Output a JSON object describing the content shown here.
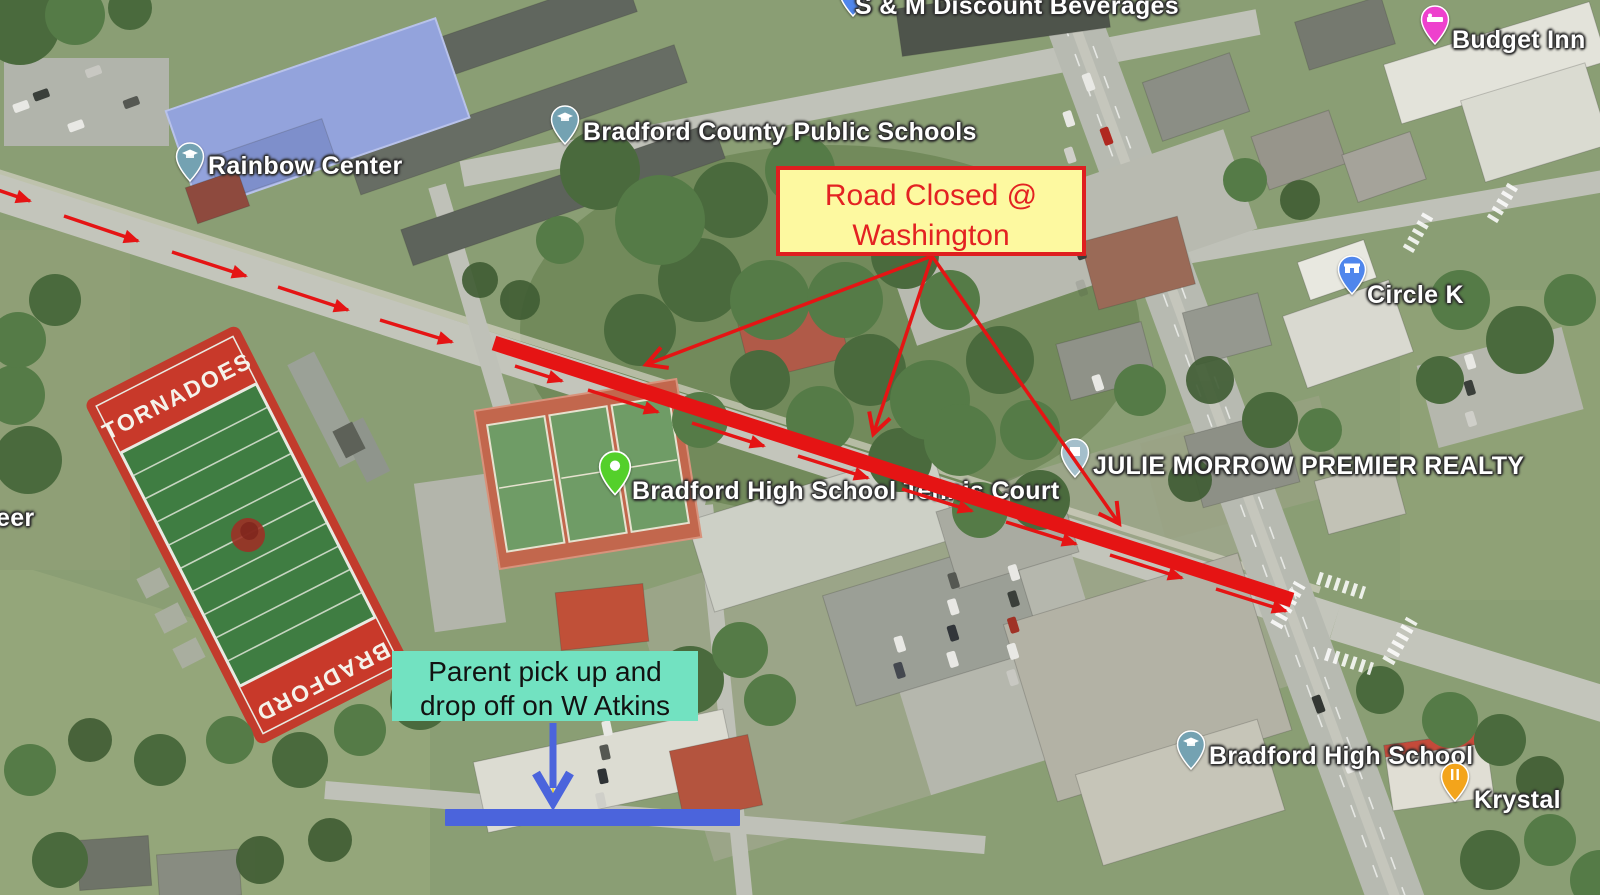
{
  "page": {
    "type": "annotated-satellite-map",
    "description": "Aerial map of Bradford High School area with road-closure and parent pick-up annotations"
  },
  "colors": {
    "annotation_red": "#e51414",
    "road_closed_bg": "#fdf9a0",
    "road_closed_border": "#df1f1f",
    "road_closed_text": "#e32222",
    "pickup_bg": "#72e2c1",
    "pickup_text": "#121212",
    "pickup_blue": "#4b64dc",
    "label_text": "#ffffff",
    "pin_school": "#74a2b2",
    "pin_tennis": "#54d02b",
    "pin_store": "#4f86ec",
    "pin_hotel": "#ee41cd",
    "pin_food": "#f3a41b",
    "pin_realty": "#a4bfcb",
    "endzone_red": "#c8392a",
    "field_green": "#3f7d42"
  },
  "map_labels": {
    "rainbow_center": "Rainbow Center",
    "bradford_county_public_schools": "Bradford County Public Schools",
    "sm_discount_beverages": "S & M Discount Beverages",
    "budget_inn": "Budget Inn",
    "circle_k": "Circle K",
    "julie_morrow_premier_realty": "JULIE MORROW PREMIER REALTY",
    "bradford_hs_tennis_court": "Bradford High School Tennis Court",
    "bradford_high_school": "Bradford High School",
    "krystal": "Krystal",
    "left_edge_partial": "reer"
  },
  "football_field": {
    "top_endzone": "TORNADOES",
    "bottom_endzone": "BRADFORD"
  },
  "annotations": {
    "road_closed": {
      "line1": "Road Closed @",
      "line2": "Washington"
    },
    "parent_pickup": {
      "line1": "Parent pick up and",
      "line2": "drop off on W Atkins"
    }
  }
}
